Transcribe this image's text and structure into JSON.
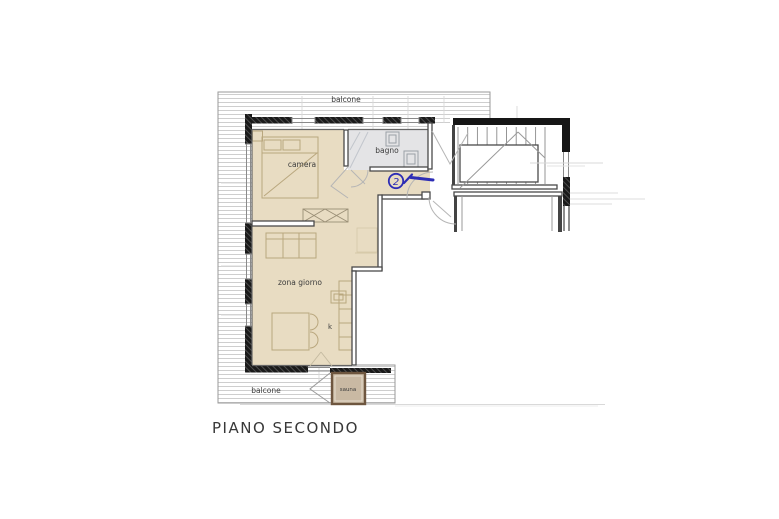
{
  "title": "PIANO SECONDO",
  "plan": {
    "labels": {
      "balcone_top": "balcone",
      "balcone_bottom": "balcone",
      "camera": "camera",
      "bagno": "bagno",
      "zona_giorno": "zona giorno",
      "kitchen": "k",
      "sauna": "sauna"
    },
    "annotation": {
      "number": "2"
    },
    "colors": {
      "room_fill": "#e8dcc2",
      "bagno_fill": "#e4e4e6",
      "sauna_fill": "#c9b9a3",
      "sauna_border": "#6e563f",
      "wall_dark": "#161616",
      "annotation_blue": "#2d2db5",
      "deck_line": "#c9c9c9"
    }
  }
}
